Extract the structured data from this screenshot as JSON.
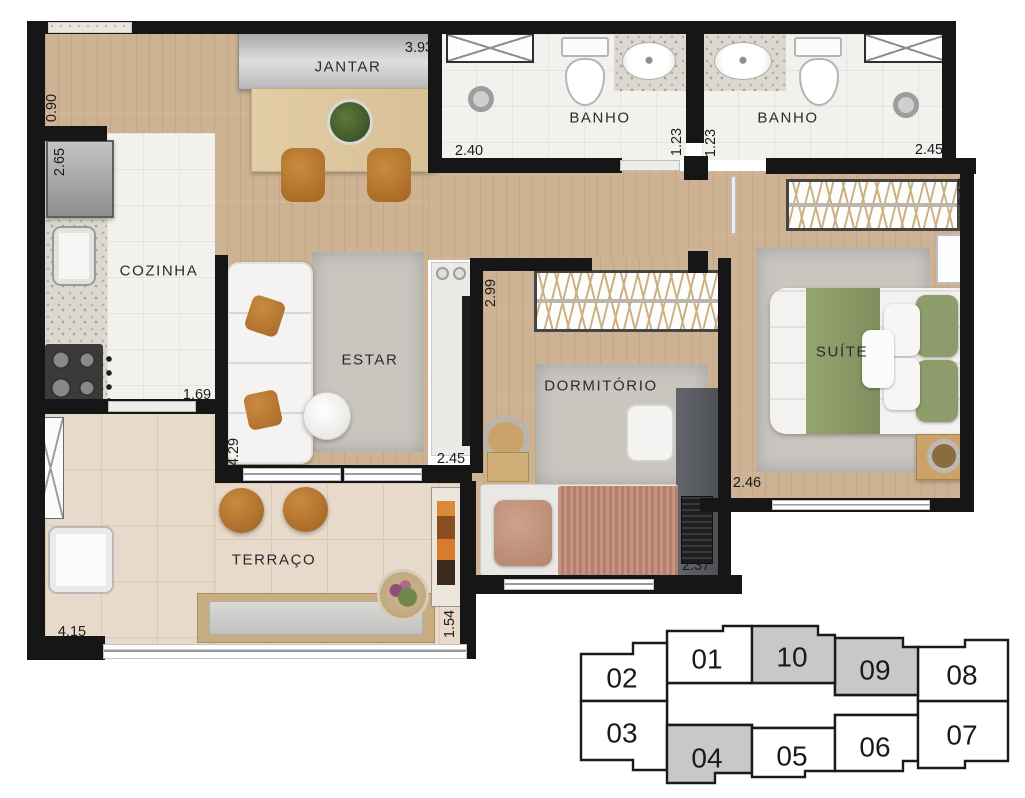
{
  "plan": {
    "rooms": [
      {
        "id": "jantar",
        "label": "JANTAR"
      },
      {
        "id": "banho-1",
        "label": "BANHO"
      },
      {
        "id": "banho-2",
        "label": "BANHO"
      },
      {
        "id": "cozinha",
        "label": "COZINHA"
      },
      {
        "id": "estar",
        "label": "ESTAR"
      },
      {
        "id": "dormitorio",
        "label": "DORMITÓRIO"
      },
      {
        "id": "suite",
        "label": "SUÍTE"
      },
      {
        "id": "terraco",
        "label": "TERRAÇO"
      }
    ],
    "dimensions": [
      {
        "id": "jantar-width",
        "value": "3.93"
      },
      {
        "id": "entry-width",
        "value": "0.90"
      },
      {
        "id": "cozinha-depth",
        "value": "2.65"
      },
      {
        "id": "banho1-width",
        "value": "2.40"
      },
      {
        "id": "banho1-depth",
        "value": "1.23"
      },
      {
        "id": "banho2-depth",
        "value": "1.23"
      },
      {
        "id": "banho2-width",
        "value": "2.45"
      },
      {
        "id": "suite-depth",
        "value": "3.17"
      },
      {
        "id": "cozinha-width",
        "value": "1.69"
      },
      {
        "id": "dormitorio-depth",
        "value": "2.99"
      },
      {
        "id": "estar-depth",
        "value": "4.29"
      },
      {
        "id": "estar-width",
        "value": "2.45"
      },
      {
        "id": "suite-width",
        "value": "2.46"
      },
      {
        "id": "dormitorio-width",
        "value": "2.37"
      },
      {
        "id": "terraco-width",
        "value": "4.15"
      },
      {
        "id": "terraco-depth",
        "value": "1.54"
      }
    ]
  },
  "keyplan": {
    "highlight_color": "#c8c8c8",
    "units": [
      {
        "label": "01",
        "highlighted": false
      },
      {
        "label": "02",
        "highlighted": false
      },
      {
        "label": "03",
        "highlighted": false
      },
      {
        "label": "04",
        "highlighted": true
      },
      {
        "label": "05",
        "highlighted": false
      },
      {
        "label": "06",
        "highlighted": false
      },
      {
        "label": "07",
        "highlighted": false
      },
      {
        "label": "08",
        "highlighted": false
      },
      {
        "label": "09",
        "highlighted": true
      },
      {
        "label": "10",
        "highlighted": true
      }
    ]
  },
  "colors": {
    "wall": "#161616",
    "wood_floor": "#cdb394",
    "tile_floor": "#f2f1ed",
    "terrace_floor": "#e7dacb",
    "rug": "#c9c6c0",
    "bed_green": "#8d9c6a",
    "leather_orange": "#b5762f",
    "keyplan_gray": "#c8c8c8"
  }
}
